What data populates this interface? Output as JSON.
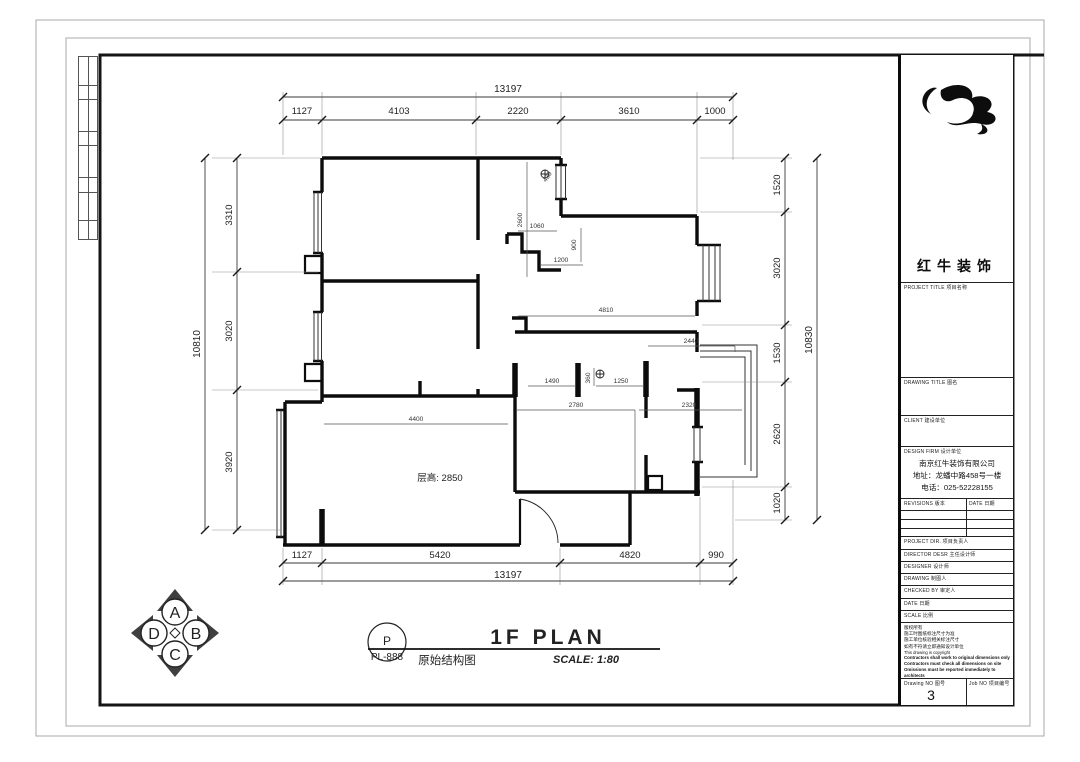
{
  "sheet": {
    "logo_text": "红牛装饰",
    "project_title_label": "PROJECT TITLE  项目名称",
    "drawing_title_label": "DRAWING TITLE  图名",
    "client_label": "CLIENT  建设单位",
    "design_firm_label": "DESIGN FIRM  设计单位",
    "firm_name": "南京红牛装饰有限公司",
    "firm_address": "地址：龙蟠中路458号一楼",
    "firm_phone": "电话：025-52228155",
    "revisions_label": "REVISIONS  版本",
    "date_col_label": "DATE 日期",
    "project_dir_label": "PROJECT DIR.  项目负责人",
    "director_label": "DIRECTOR DESR  主任设计师",
    "designer_label": "DESIGNER  设计师",
    "drawing_label": "DRAWING  制图人",
    "checked_label": "CHECKED BY  审定人",
    "date_label": "DATE  日期",
    "scale_label": "SCALE  比例",
    "notes": [
      "版权所有",
      "施工时图纸标注尺寸为准",
      "施工单位核验相关标注尺寸",
      "如有不符请立即通知设计单位"
    ],
    "note_en": "This drawing is copyright",
    "notes_bold": [
      "Contractors shall work to original dimensions only",
      "Contractors must check all dimensions on site",
      "Omissions must be reported immediately to architects"
    ],
    "drawing_no_label": "Drawing NO  图号",
    "drawing_no": "3",
    "job_no_label": "Job NO  项目编号"
  },
  "titlebar": {
    "plan_title": "1F PLAN",
    "plan_subtitle": "原始结构图",
    "scale_text": "SCALE:  1:80",
    "tag_top": "P",
    "tag_bottom": "PL-888"
  },
  "compass": {
    "top": "A",
    "right": "B",
    "bottom": "C",
    "left": "D"
  },
  "plan": {
    "room_note": "层高: 2850",
    "dims_top": [
      "1127",
      "4103",
      "2220",
      "3610",
      "1000"
    ],
    "dims_top_total": "13197",
    "dims_left": [
      "3310",
      "3020",
      "3920"
    ],
    "dims_left_total": "10810",
    "dims_right": [
      "1520",
      "3020",
      "1530",
      "2620",
      "1020"
    ],
    "dims_right_total": "10830",
    "dims_bottom": [
      "1127",
      "5420",
      "4820",
      "990"
    ],
    "dims_bottom_total": "13197",
    "inner": {
      "d2600": "2600",
      "d430": "430",
      "d1060": "1060",
      "d900": "900",
      "d1200": "1200",
      "d4810": "4810",
      "d2440": "2440",
      "d1490": "1490",
      "d360": "360",
      "d1250": "1250",
      "d2780": "2780",
      "d2320": "2320",
      "d4400": "4400"
    }
  }
}
